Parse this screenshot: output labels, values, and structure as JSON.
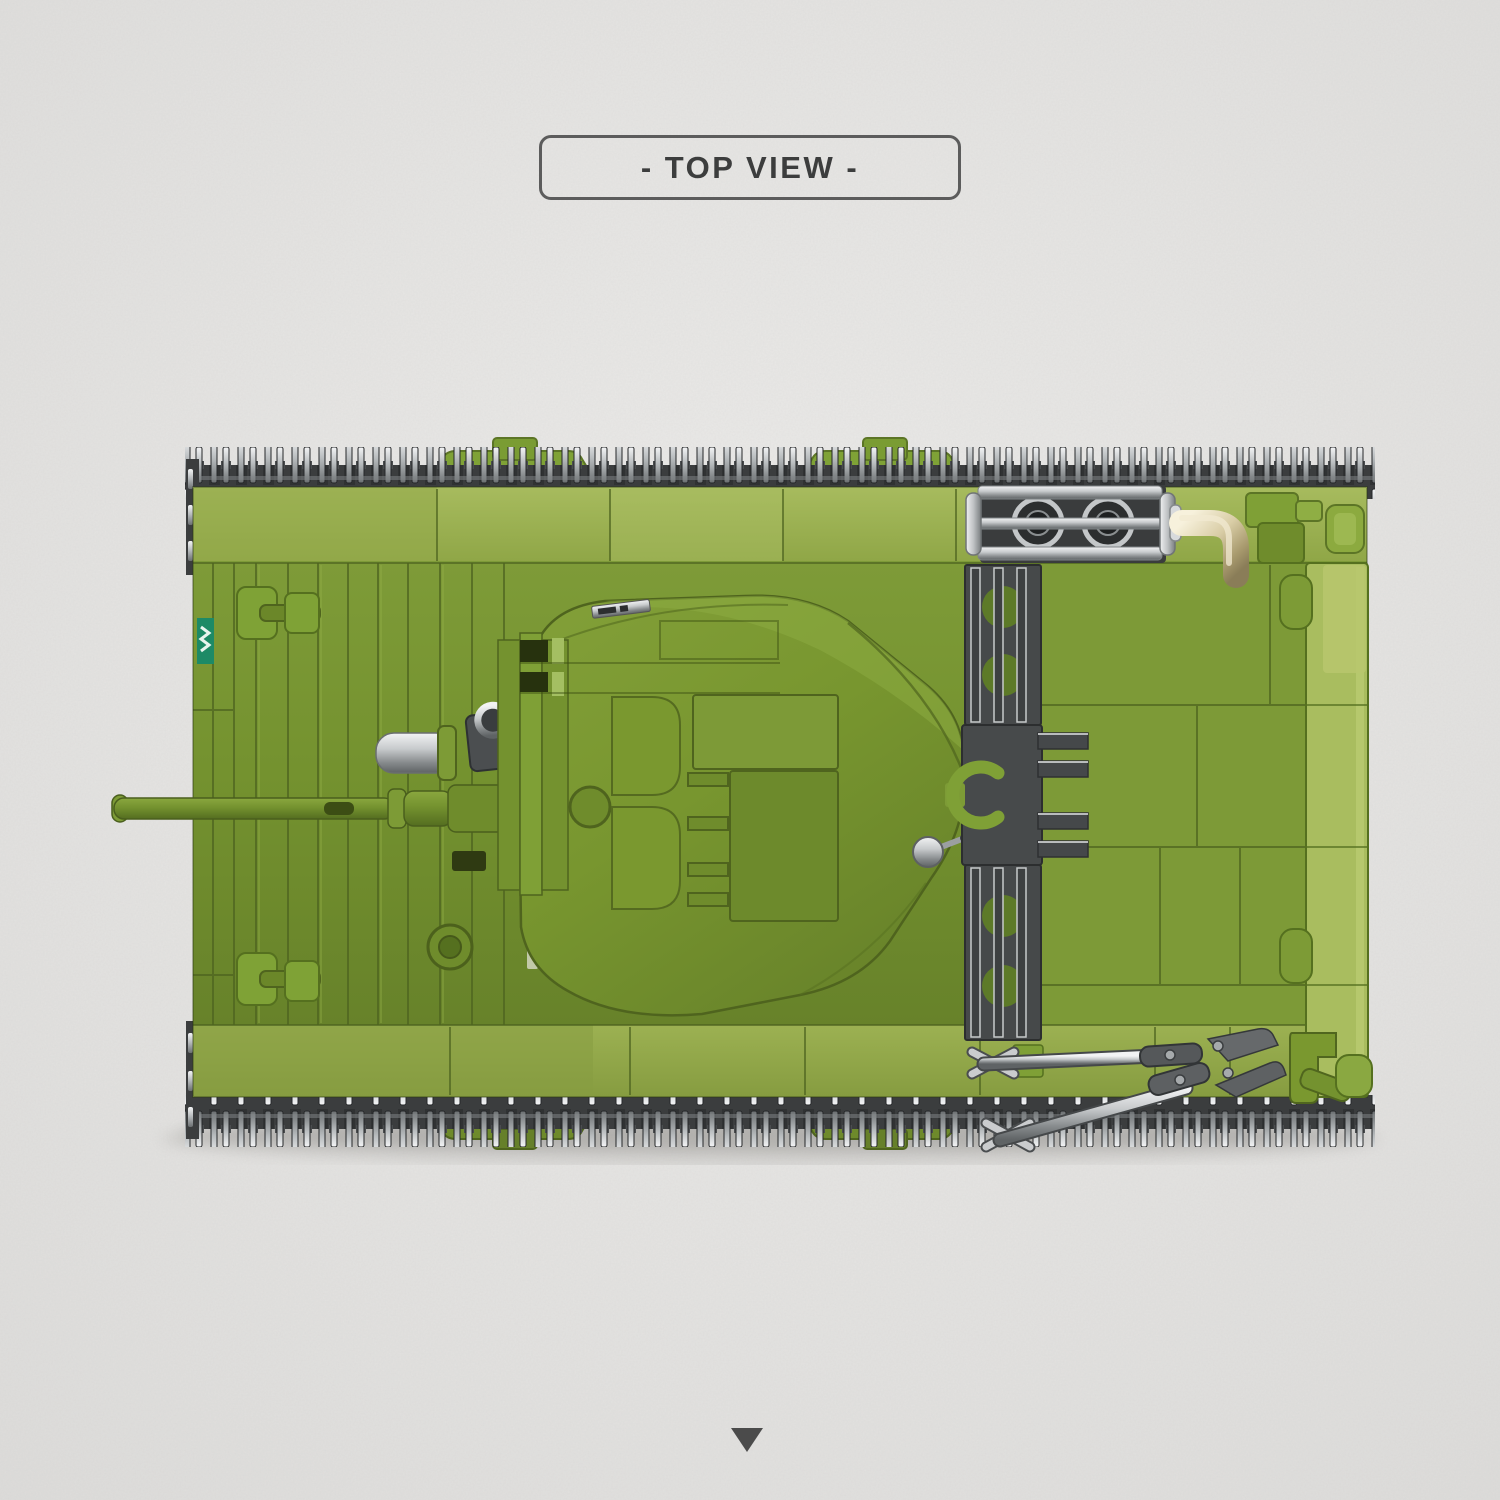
{
  "header": {
    "label": "- TOP VIEW -"
  },
  "footer": {
    "indicator_icon": "down-triangle-icon"
  },
  "subject_icons": {
    "main_image": "tank-top-view-illustration",
    "parts": [
      "track",
      "hull",
      "turret",
      "gun-barrel",
      "muffler",
      "exhaust-elbow-pipe",
      "engine-grille",
      "tow-cable-clamp",
      "hatch-ring",
      "bolt-cutters-tool",
      "tow-hook",
      "side-skirt"
    ]
  },
  "palette": {
    "bg": "#e6e5e3",
    "label-border": "#5c5c5c",
    "label-text": "#3c3d3d",
    "green-main": "#74922f",
    "green-light": "#85a33b",
    "green-pale": "#9db255",
    "green-deck": "#7d9a37",
    "green-dark": "#5c7526",
    "green-skirt": "#a9bd5f",
    "track-dark": "#3b3d3e",
    "silver": "#c7cacc",
    "silver-dark": "#6f7375",
    "dark-part": "#474a4b",
    "gold": "#d9cda6",
    "sticker-teal": "#1d8a66",
    "shadow": "#94938f",
    "triangle": "#4b4b4b"
  }
}
